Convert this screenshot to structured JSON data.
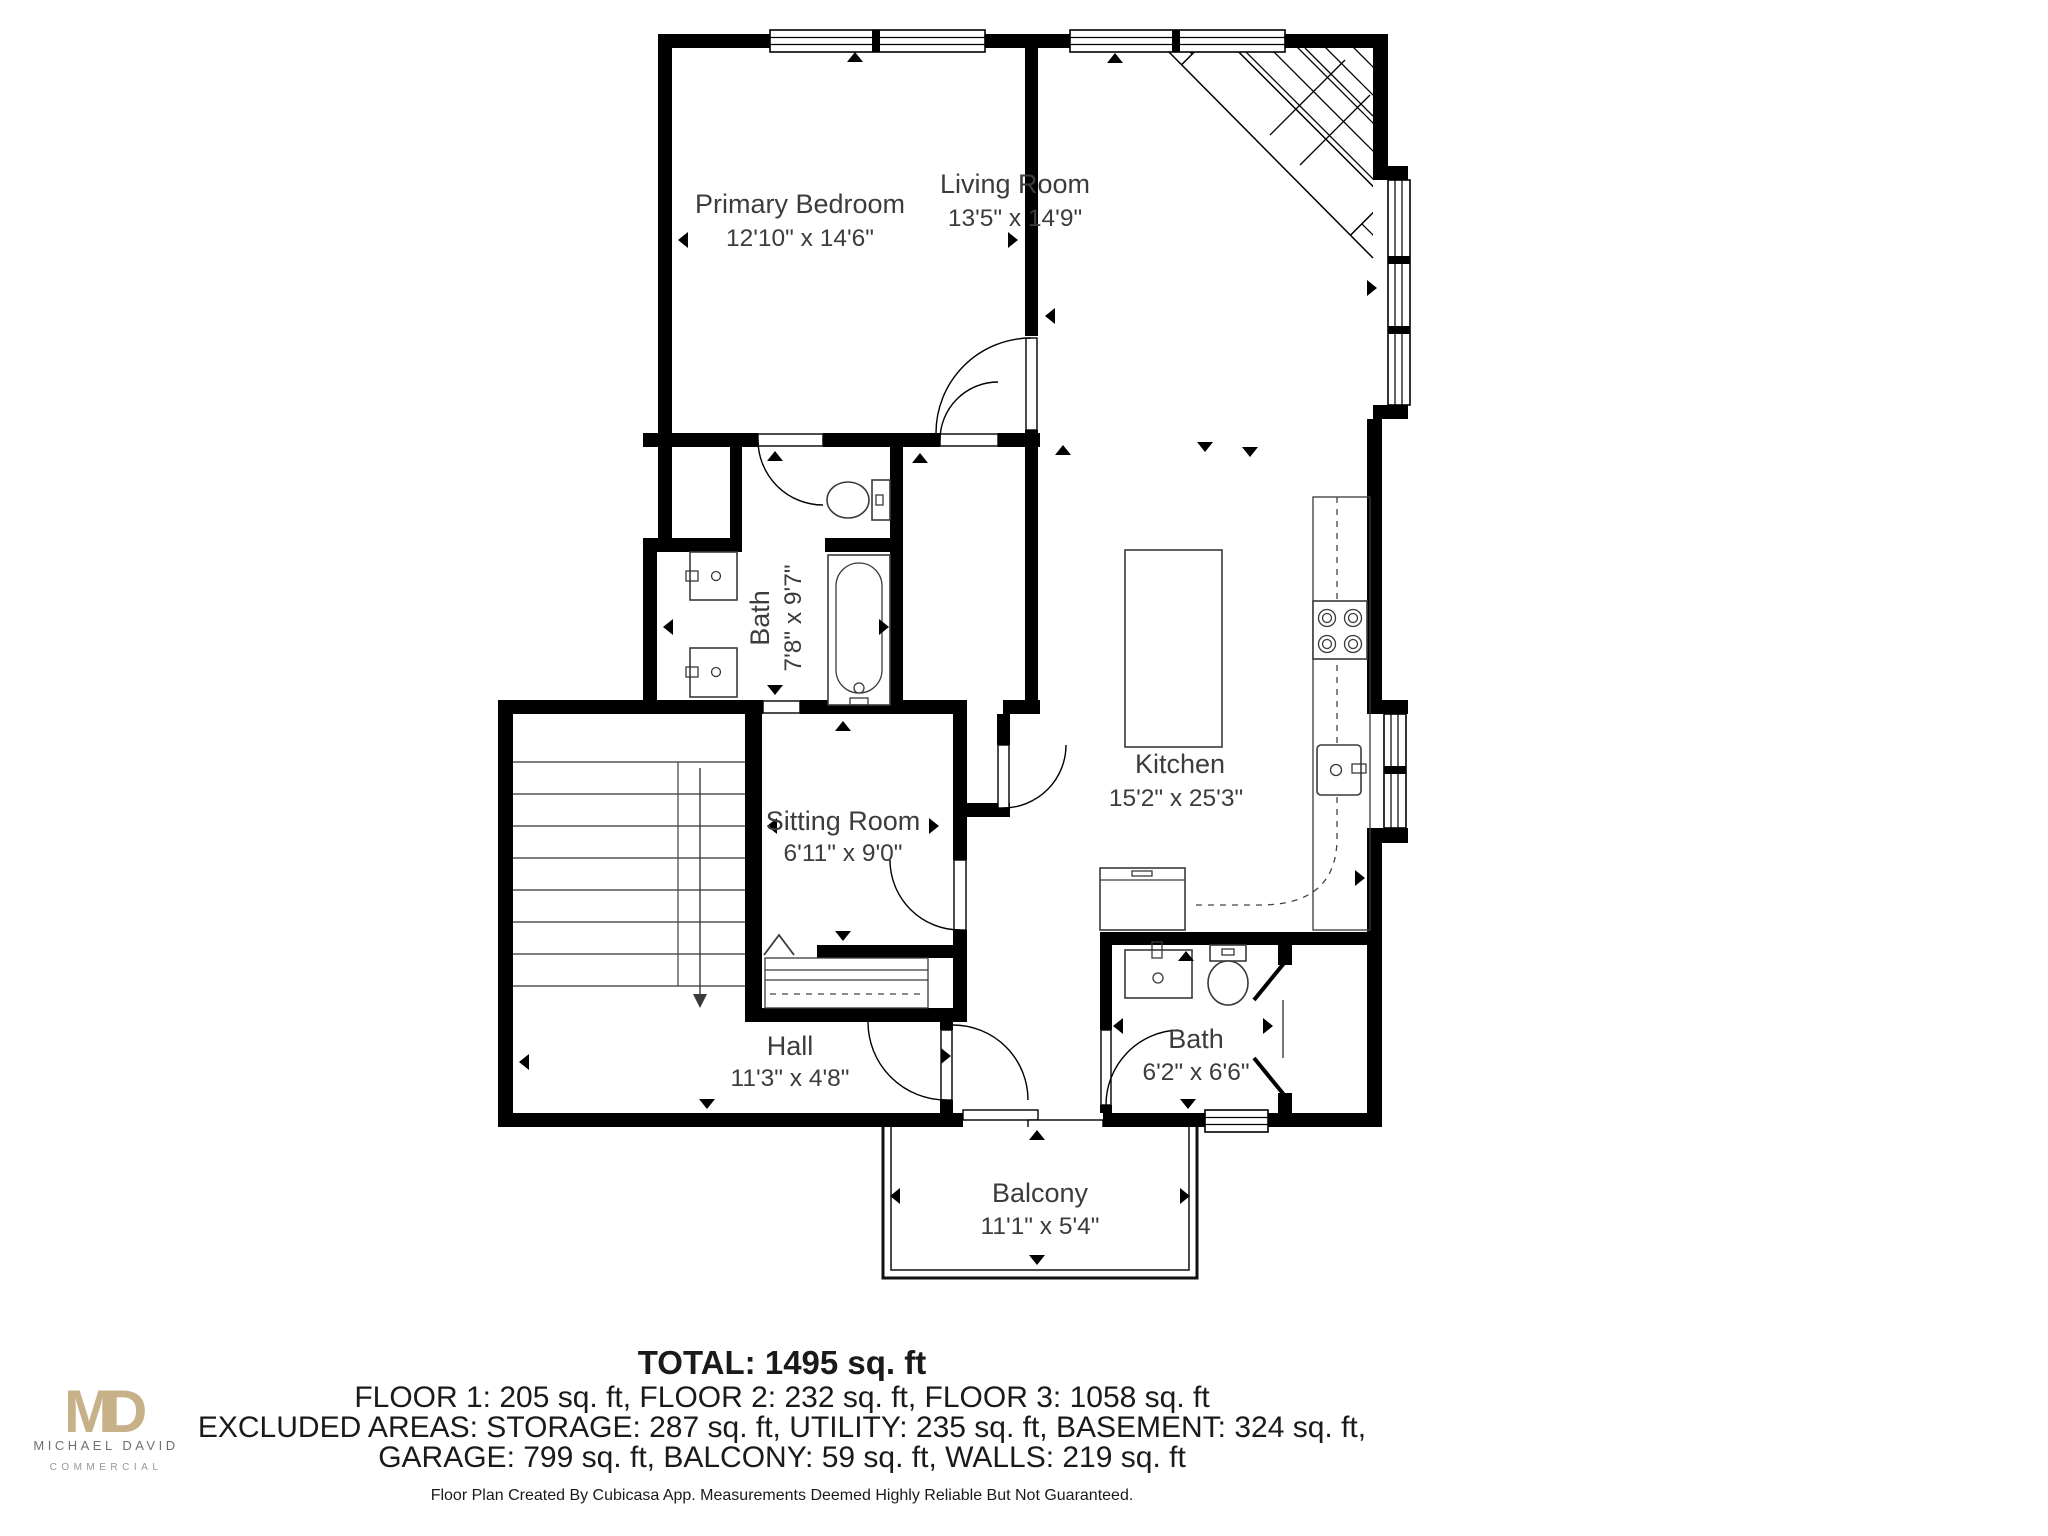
{
  "plan": {
    "rooms": [
      {
        "name": "Primary Bedroom",
        "dims": "12'10\" x 14'6\""
      },
      {
        "name": "Living Room",
        "dims": "13'5\" x 14'9\""
      },
      {
        "name": "Bath",
        "dims": "7'8\" x 9'7\""
      },
      {
        "name": "Kitchen",
        "dims": "15'2\" x 25'3\""
      },
      {
        "name": "Sitting Room",
        "dims": "6'11\" x 9'0\""
      },
      {
        "name": "Hall",
        "dims": "11'3\" x 4'8\""
      },
      {
        "name": "Bath",
        "dims": "6'2\" x 6'6\""
      },
      {
        "name": "Balcony",
        "dims": "11'1\" x 5'4\""
      }
    ],
    "fixtures": [
      "staircase-corner-hatch",
      "window",
      "door-swing",
      "toilet",
      "bathtub",
      "vanity-sink",
      "vanity-sink",
      "kitchen-island",
      "stove-burners",
      "kitchen-sink",
      "counter",
      "washer",
      "staircase",
      "wardrobe",
      "chevron-ceiling-mark",
      "toilet",
      "sink",
      "pocket-door",
      "sliding-balcony-door"
    ]
  },
  "summary": {
    "total_label": "TOTAL: 1495 sq. ft",
    "floors_line": "FLOOR 1: 205 sq. ft, FLOOR 2: 232 sq. ft, FLOOR 3: 1058 sq. ft",
    "excluded_line_1": "EXCLUDED AREAS: STORAGE: 287 sq. ft, UTILITY: 235 sq. ft, BASEMENT: 324 sq. ft,",
    "excluded_line_2": "GARAGE: 799 sq. ft, BALCONY: 59 sq. ft, WALLS: 219 sq. ft",
    "total_sqft": 1495,
    "floor1_sqft": 205,
    "floor2_sqft": 232,
    "floor3_sqft": 1058,
    "storage_sqft": 287,
    "utility_sqft": 235,
    "basement_sqft": 324,
    "garage_sqft": 799,
    "balcony_sqft": 59,
    "walls_sqft": 219
  },
  "disclaimer": "Floor Plan Created By Cubicasa App. Measurements Deemed Highly Reliable But Not Guaranteed.",
  "logo": {
    "monogram_m": "M",
    "monogram_d": "D",
    "name": "MICHAEL DAVID",
    "division": "COMMERCIAL",
    "gold": "#c7b189",
    "gray": "#6f6f6f"
  },
  "colors": {
    "walls": "#000000",
    "label_text": "#3c3c3c",
    "fixture_line": "#3a3a3a"
  }
}
